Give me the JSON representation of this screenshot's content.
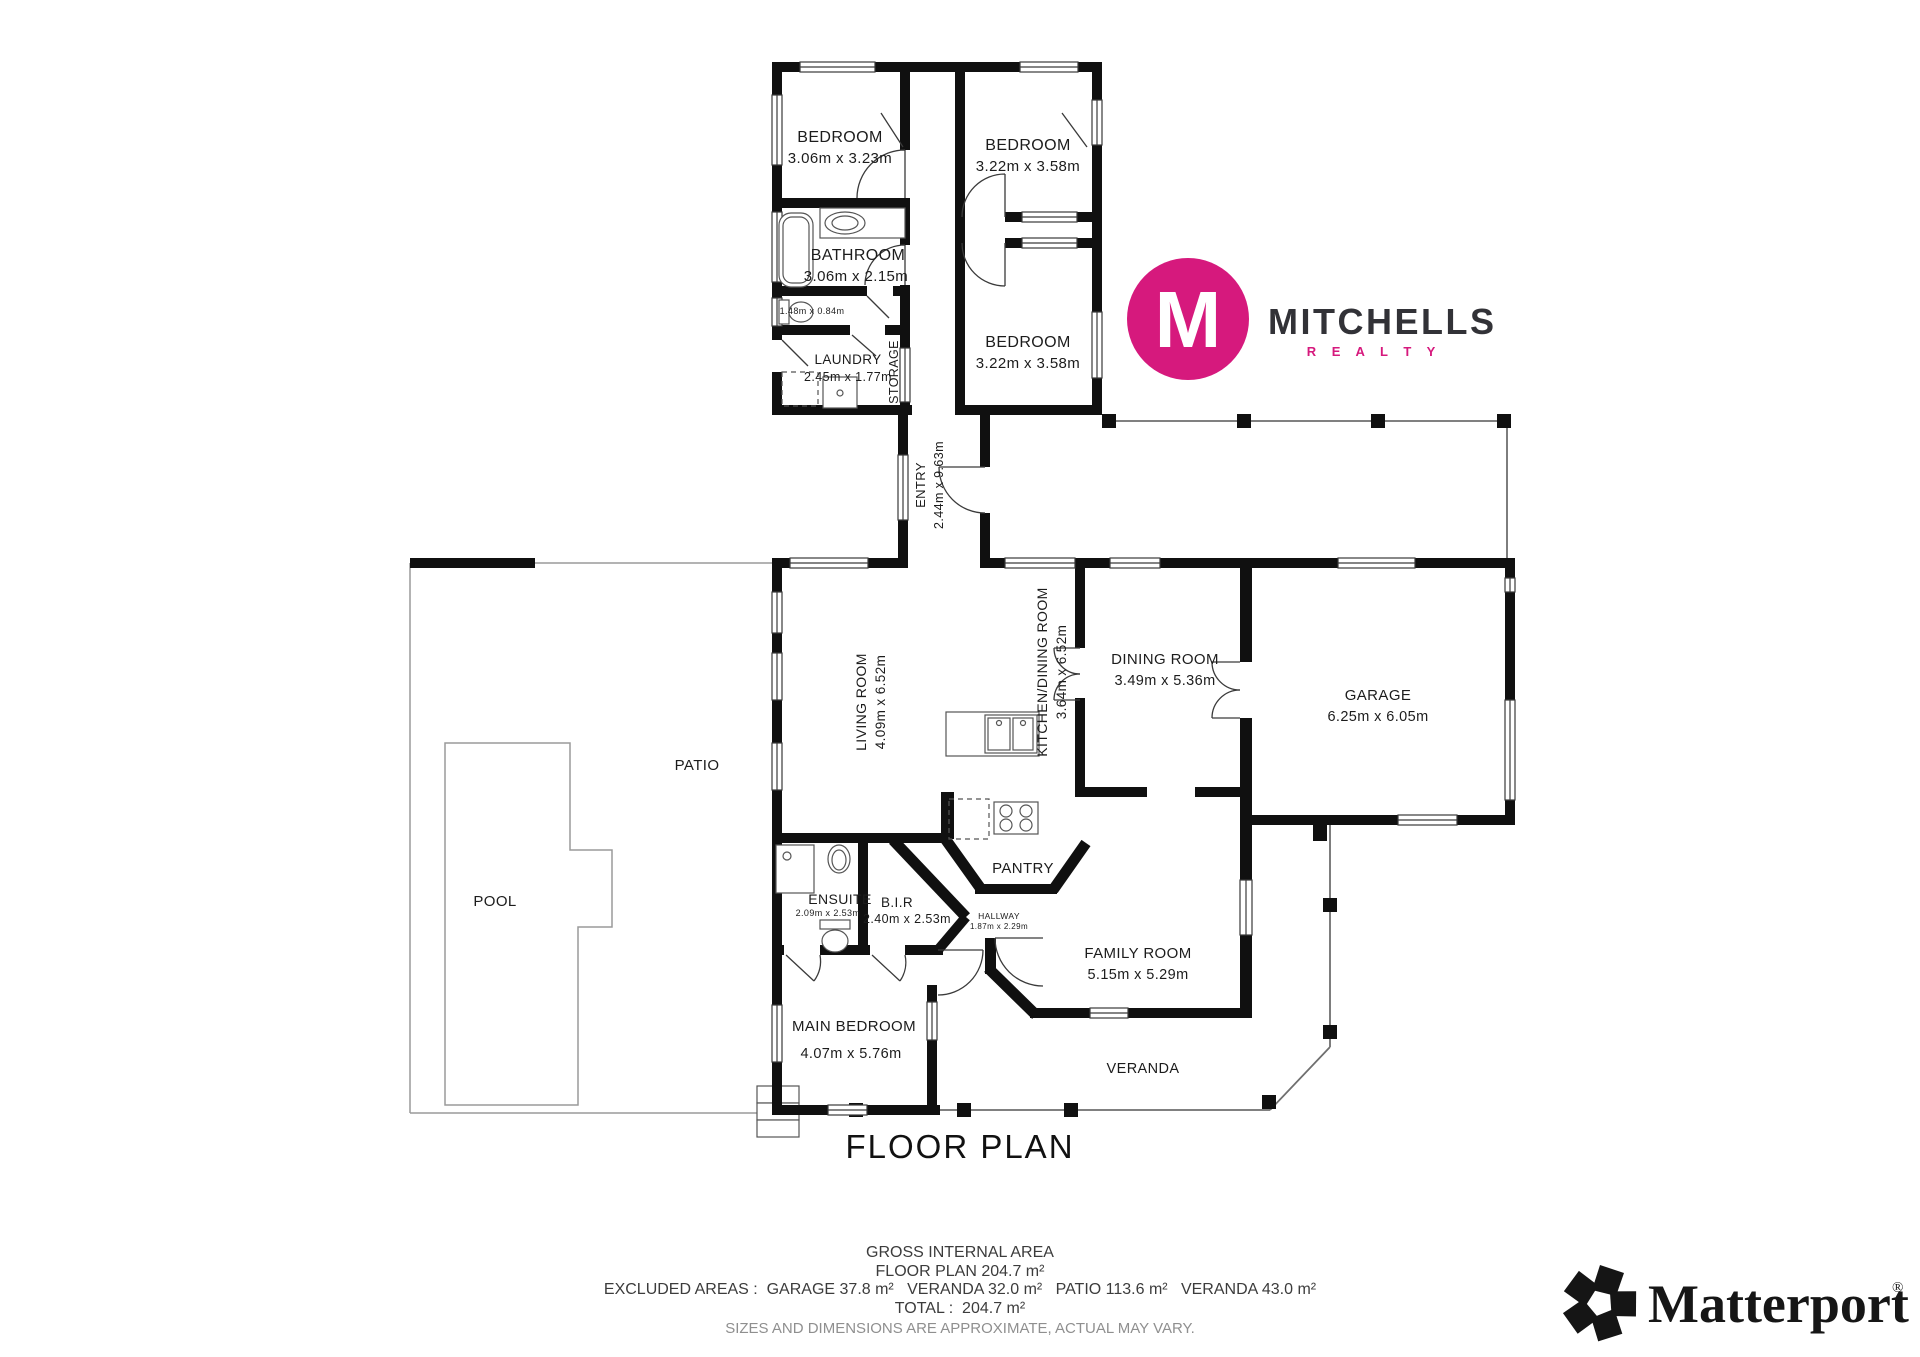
{
  "page": {
    "title": "FLOOR PLAN"
  },
  "branding": {
    "mitchells": {
      "monogram": "M",
      "name": "MITCHELLS",
      "sub": "R E A L T Y",
      "pink": "#d6197d",
      "dark": "#323237"
    },
    "matterport": {
      "name": "Matterport",
      "registered": "®"
    }
  },
  "rooms": {
    "bedroom1": {
      "name": "BEDROOM",
      "dims": "3.06m x 3.23m"
    },
    "bedroom2": {
      "name": "BEDROOM",
      "dims": "3.22m x 3.58m"
    },
    "bedroom3": {
      "name": "BEDROOM",
      "dims": "3.22m x 3.58m"
    },
    "bathroom": {
      "name": "BATHROOM",
      "dims": "3.06m x 2.15m"
    },
    "wc": {
      "dims": "1.48m x 0.84m"
    },
    "laundry": {
      "name": "LAUNDRY",
      "dims": "2.45m x 1.77m"
    },
    "storage": {
      "name": "STORAGE"
    },
    "entry": {
      "name": "ENTRY",
      "dims": "2.44m x 9.63m"
    },
    "living_room": {
      "name": "LIVING ROOM",
      "dims": "4.09m x 6.52m"
    },
    "kitchen_dining": {
      "name": "KITCHEN/DINING ROOM",
      "dims": "3.64m x 6.52m"
    },
    "dining_room": {
      "name": "DINING ROOM",
      "dims": "3.49m x 5.36m"
    },
    "garage": {
      "name": "GARAGE",
      "dims": "6.25m x 6.05m"
    },
    "patio": {
      "name": "PATIO"
    },
    "pool": {
      "name": "POOL"
    },
    "ensuite": {
      "name": "ENSUITE",
      "dims": "2.09m x 2.53m"
    },
    "bir": {
      "name": "B.I.R",
      "dims": "2.40m x 2.53m"
    },
    "hallway": {
      "name": "HALLWAY",
      "dims": "1.87m x 2.29m"
    },
    "pantry": {
      "name": "PANTRY"
    },
    "family_room": {
      "name": "FAMILY ROOM",
      "dims": "5.15m x 5.29m"
    },
    "main_bedroom": {
      "name": "MAIN BEDROOM",
      "dims": "4.07m x 5.76m"
    },
    "veranda": {
      "name": "VERANDA"
    }
  },
  "summary": {
    "heading": "GROSS INTERNAL AREA",
    "floor_plan": "FLOOR PLAN 204.7 m²",
    "excluded": "EXCLUDED AREAS :  GARAGE 37.8 m²   VERANDA 32.0 m²   PATIO 113.6 m²   VERANDA 43.0 m²",
    "total": "TOTAL :  204.7 m²",
    "disclaimer": "SIZES AND DIMENSIONS ARE APPROXIMATE, ACTUAL MAY VARY."
  }
}
